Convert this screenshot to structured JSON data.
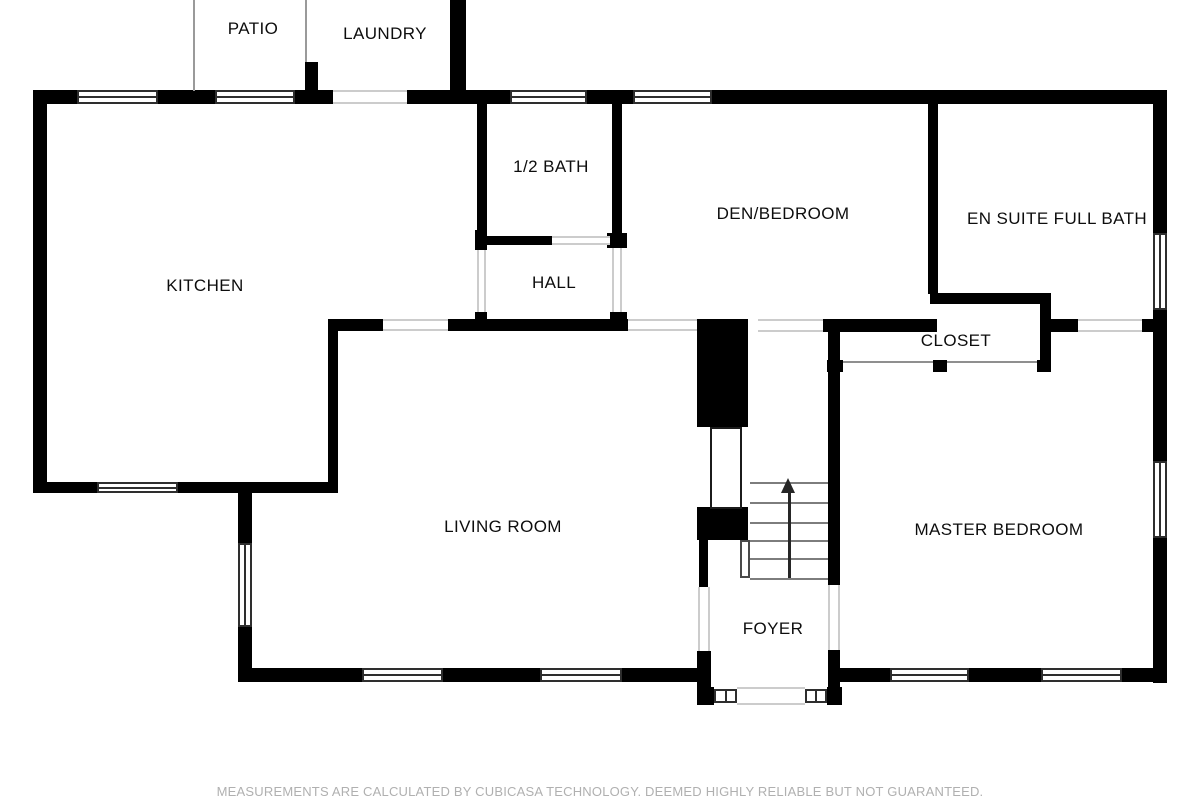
{
  "footer": {
    "text": "MEASUREMENTS ARE CALCULATED BY CUBICASA TECHNOLOGY. DEEMED HIGHLY RELIABLE BUT NOT GUARANTEED."
  },
  "colors": {
    "wall": "#000000",
    "background": "#ffffff",
    "window_frame": "#2e2e2e",
    "opening_line": "#cccccc",
    "stair_line": "#7d7d7d",
    "footer_text": "#b0b0b0"
  },
  "floorplan": {
    "rooms": [
      {
        "id": "patio",
        "label": "PATIO",
        "cx": 253,
        "cy": 29
      },
      {
        "id": "laundry",
        "label": "LAUNDRY",
        "cx": 385,
        "cy": 34
      },
      {
        "id": "kitchen",
        "label": "KITCHEN",
        "cx": 205,
        "cy": 286
      },
      {
        "id": "half-bath",
        "label": "1/2 BATH",
        "cx": 551,
        "cy": 167
      },
      {
        "id": "hall",
        "label": "HALL",
        "cx": 554,
        "cy": 283
      },
      {
        "id": "den-bedroom",
        "label": "DEN/BEDROOM",
        "cx": 783,
        "cy": 214
      },
      {
        "id": "en-suite-full-bath",
        "label": "EN SUITE FULL BATH",
        "cx": 1057,
        "cy": 219
      },
      {
        "id": "closet",
        "label": "CLOSET",
        "cx": 956,
        "cy": 341
      },
      {
        "id": "living-room",
        "label": "LIVING ROOM",
        "cx": 503,
        "cy": 527
      },
      {
        "id": "master-bedroom",
        "label": "MASTER BEDROOM",
        "cx": 999,
        "cy": 530
      },
      {
        "id": "foyer",
        "label": "FOYER",
        "cx": 773,
        "cy": 629
      }
    ],
    "walls": [
      [
        33,
        90,
        44,
        14
      ],
      [
        158,
        90,
        57,
        14
      ],
      [
        295,
        90,
        38,
        14
      ],
      [
        407,
        90,
        103,
        14
      ],
      [
        587,
        90,
        46,
        14
      ],
      [
        712,
        90,
        455,
        14
      ],
      [
        450,
        0,
        16,
        104
      ],
      [
        305,
        62,
        13,
        42
      ],
      [
        33,
        90,
        14,
        403
      ],
      [
        33,
        482,
        64,
        11
      ],
      [
        178,
        482,
        160,
        11
      ],
      [
        328,
        319,
        10,
        174
      ],
      [
        328,
        319,
        55,
        12
      ],
      [
        448,
        319,
        180,
        12
      ],
      [
        823,
        319,
        114,
        13
      ],
      [
        477,
        103,
        10,
        142
      ],
      [
        612,
        103,
        10,
        145
      ],
      [
        607,
        233,
        20,
        15
      ],
      [
        477,
        236,
        75,
        9
      ],
      [
        475,
        230,
        12,
        20
      ],
      [
        475,
        312,
        12,
        19
      ],
      [
        610,
        312,
        17,
        19
      ],
      [
        928,
        104,
        10,
        190
      ],
      [
        930,
        293,
        120,
        11
      ],
      [
        1040,
        293,
        11,
        79
      ],
      [
        827,
        360,
        16,
        12
      ],
      [
        933,
        360,
        14,
        12
      ],
      [
        1037,
        360,
        14,
        12
      ],
      [
        1048,
        319,
        30,
        13
      ],
      [
        1142,
        319,
        12,
        13
      ],
      [
        1153,
        90,
        14,
        143
      ],
      [
        1153,
        310,
        14,
        151
      ],
      [
        1153,
        538,
        14,
        145
      ],
      [
        828,
        319,
        12,
        266
      ],
      [
        828,
        650,
        12,
        55
      ],
      [
        697,
        319,
        51,
        108
      ],
      [
        697,
        507,
        51,
        33
      ],
      [
        699,
        540,
        9,
        47
      ],
      [
        697,
        651,
        14,
        54
      ],
      [
        697,
        687,
        17,
        18
      ],
      [
        827,
        687,
        15,
        18
      ],
      [
        238,
        668,
        124,
        14
      ],
      [
        443,
        668,
        97,
        14
      ],
      [
        622,
        668,
        78,
        14
      ],
      [
        840,
        668,
        50,
        14
      ],
      [
        969,
        668,
        72,
        14
      ],
      [
        1122,
        668,
        45,
        14
      ],
      [
        238,
        492,
        14,
        51
      ],
      [
        238,
        627,
        14,
        55
      ]
    ],
    "windows_h": [
      [
        77,
        90,
        81,
        14
      ],
      [
        215,
        90,
        80,
        14
      ],
      [
        510,
        90,
        77,
        14
      ],
      [
        633,
        90,
        79,
        14
      ],
      [
        97,
        482,
        81,
        11
      ],
      [
        362,
        668,
        81,
        14
      ],
      [
        540,
        668,
        82,
        14
      ],
      [
        890,
        668,
        79,
        14
      ],
      [
        1041,
        668,
        81,
        14
      ]
    ],
    "windows_v": [
      [
        238,
        543,
        14,
        84
      ],
      [
        1153,
        233,
        14,
        77
      ],
      [
        1153,
        461,
        14,
        77
      ]
    ],
    "windows_small": [
      [
        714,
        689,
        23,
        14
      ],
      [
        805,
        689,
        22,
        14
      ]
    ],
    "openings_h": [
      [
        333,
        90,
        74,
        14
      ],
      [
        552,
        236,
        58,
        9
      ],
      [
        383,
        319,
        65,
        12
      ],
      [
        628,
        319,
        69,
        12
      ],
      [
        758,
        319,
        65,
        13
      ],
      [
        1078,
        319,
        64,
        13
      ],
      [
        737,
        687,
        68,
        18
      ]
    ],
    "openings_v": [
      [
        477,
        250,
        9,
        62
      ],
      [
        612,
        248,
        10,
        64
      ],
      [
        828,
        585,
        12,
        65
      ],
      [
        698,
        587,
        12,
        64
      ]
    ],
    "boundary_lines": [
      [
        193,
        0,
        2,
        91
      ],
      [
        305,
        0,
        2,
        62
      ]
    ],
    "slide_lines": [
      [
        843,
        361,
        90,
        2
      ],
      [
        947,
        361,
        90,
        2
      ]
    ],
    "door_leaf": [
      710,
      427,
      32,
      82
    ],
    "stairs": {
      "tread_x": 750,
      "tread_w": 78,
      "tread_ys": [
        482,
        502,
        522,
        540,
        558,
        578
      ],
      "side": [
        740,
        540,
        10,
        38
      ],
      "arrow_line": [
        788,
        492,
        3,
        86
      ],
      "arrow_head": [
        781,
        478
      ]
    }
  }
}
